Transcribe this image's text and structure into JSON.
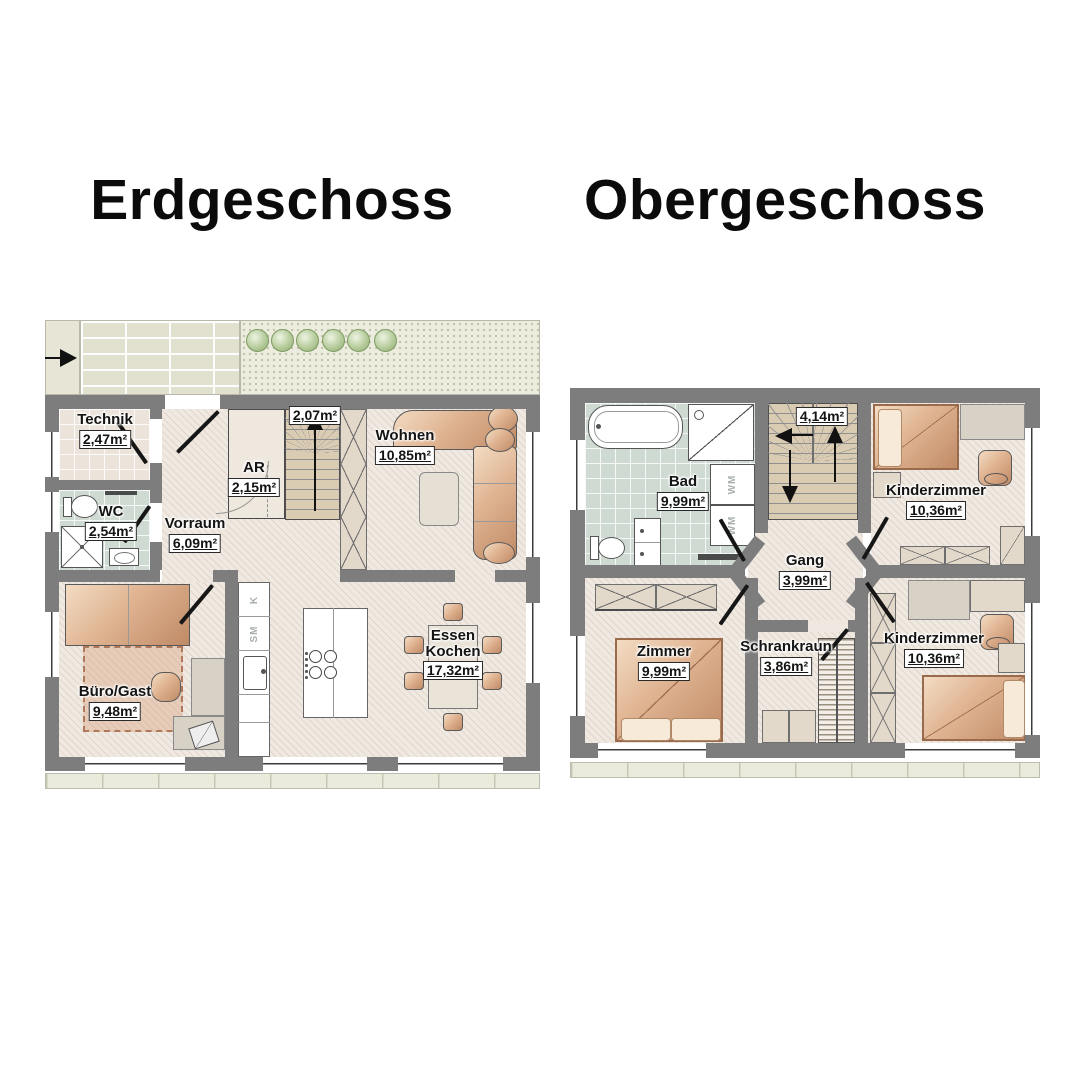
{
  "titles": {
    "left": "Erdgeschoss",
    "right": "Obergeschoss"
  },
  "erdgeschoss": {
    "rooms": {
      "technik": {
        "name": "Technik",
        "area": "2,47m²"
      },
      "wc": {
        "name": "WC",
        "area": "2,54m²"
      },
      "vorraum": {
        "name": "Vorraum",
        "area": "6,09m²"
      },
      "abstellraum": {
        "name": "AR",
        "area": "2,15m²"
      },
      "stiege": {
        "area": "2,07m²"
      },
      "wohnen": {
        "name": "Wohnen",
        "area": "10,85m²"
      },
      "buero_gast": {
        "name": "Büro/Gast",
        "area": "9,48m²"
      },
      "essen_kochen": {
        "name": "Essen Kochen",
        "area": "17,32m²"
      }
    },
    "appliances": {
      "kuehlschrank": "K",
      "spuelmaschine": "SM"
    }
  },
  "obergeschoss": {
    "rooms": {
      "bad": {
        "name": "Bad",
        "area": "9,99m²"
      },
      "stiege": {
        "area": "4,14m²"
      },
      "kinderzimmer_oben": {
        "name": "Kinderzimmer",
        "area": "10,36m²"
      },
      "gang": {
        "name": "Gang",
        "area": "3,99m²"
      },
      "zimmer": {
        "name": "Zimmer",
        "area": "9,99m²"
      },
      "schrankraum": {
        "name": "Schrankraun",
        "area": "3,86m²"
      },
      "kinderzimmer_unten": {
        "name": "Kinderzimmer",
        "area": "10,36m²"
      }
    },
    "appliances": {
      "waschmaschine": "WM"
    }
  },
  "colors": {
    "wall": "#7d7d7d",
    "floor_beige": "#f0e9e1",
    "tile_bath": "#cfdad2",
    "furniture_tan": "#d9a886",
    "wardrobe_beige": "#e3d9cb",
    "stair_tread": "#dacbb3",
    "bush_green": "#a9c48d"
  }
}
